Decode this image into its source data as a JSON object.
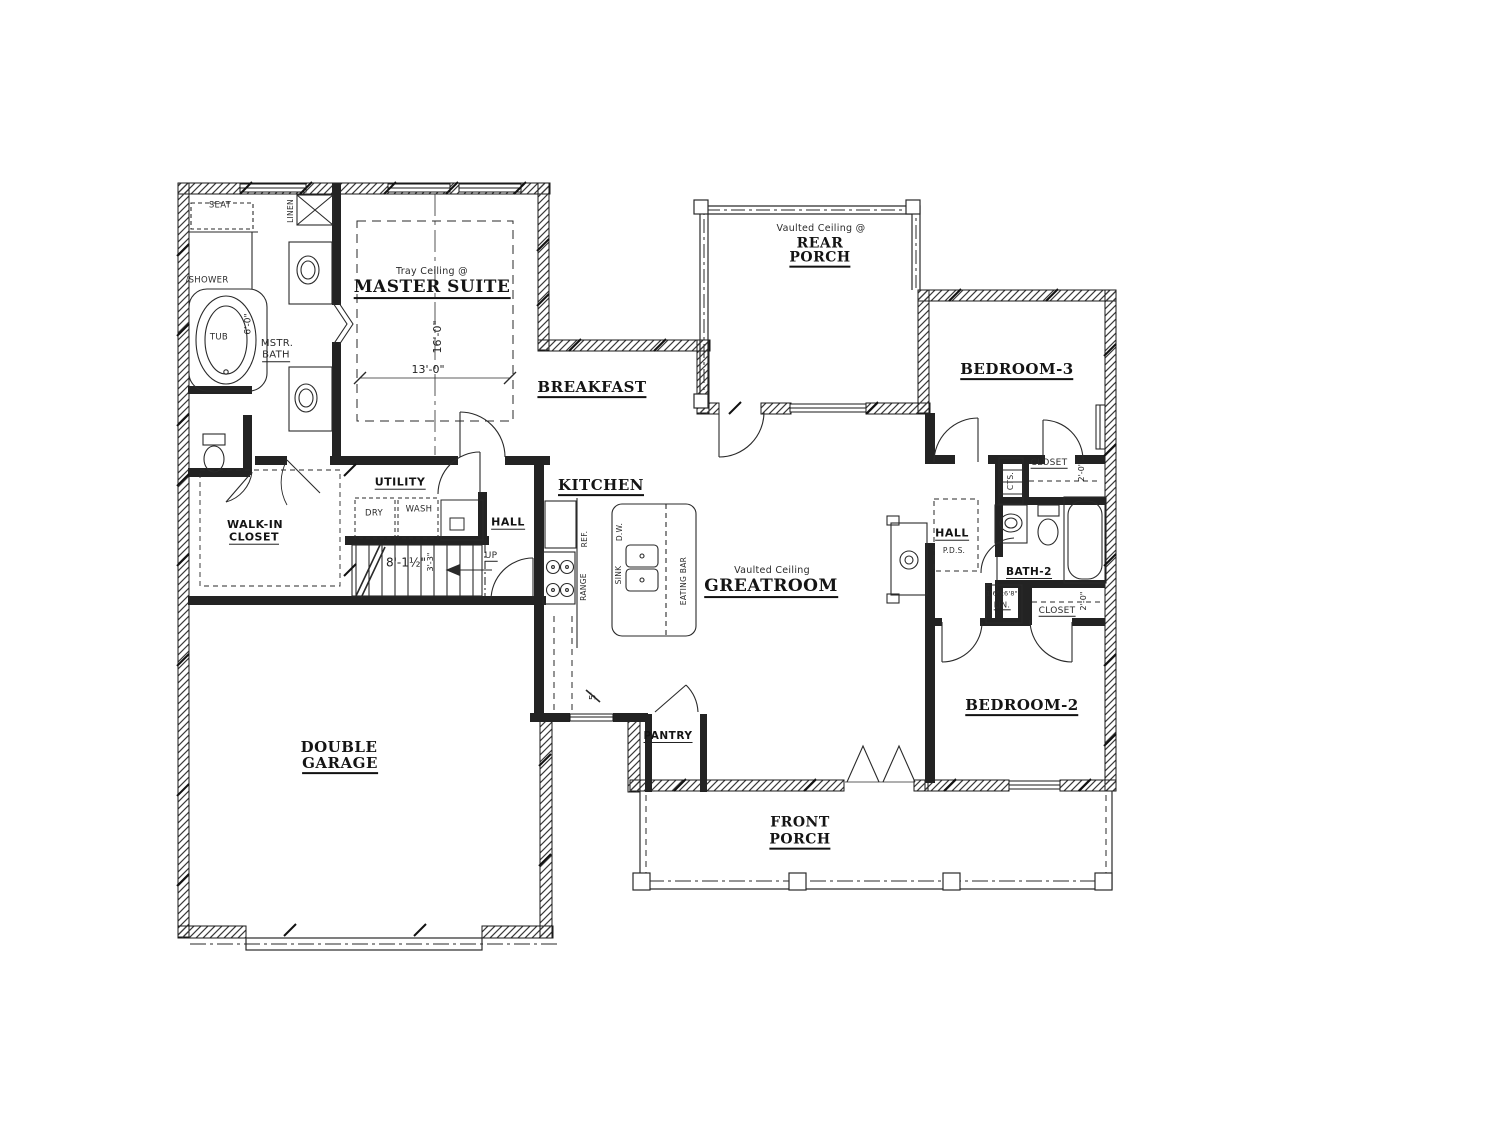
{
  "rooms": {
    "master_suite": {
      "label": "MASTER SUITE",
      "ceiling": "Tray Ceiling @",
      "depth": "16'-0\"",
      "width": "13'-0\""
    },
    "master_bath": {
      "label_line1": "MSTR.",
      "label_line2": "BATH"
    },
    "walk_in_closet": {
      "label_line1": "WALK-IN",
      "label_line2": "CLOSET"
    },
    "breakfast": {
      "label": "BREAKFAST"
    },
    "kitchen": {
      "label": "KITCHEN",
      "counter_dim": "5'"
    },
    "utility": {
      "label": "UTILITY"
    },
    "hall_main": {
      "label": "HALL"
    },
    "hall_bedroom": {
      "label": "HALL",
      "note": "P.D.S."
    },
    "stairs": {
      "dim_run": "8'-1½\"",
      "dim_width": "3'-3\"",
      "direction": "UP"
    },
    "rear_porch": {
      "label_line1": "REAR",
      "label_line2": "PORCH",
      "ceiling": "Vaulted Ceiling @"
    },
    "greatroom": {
      "label": "GREATROOM",
      "ceiling": "Vaulted Ceiling"
    },
    "bedroom_3": {
      "label": "BEDROOM-3"
    },
    "bedroom_2": {
      "label": "BEDROOM-2"
    },
    "bath_2": {
      "label": "BATH-2"
    },
    "double_garage": {
      "label_line1": "DOUBLE",
      "label_line2": "GARAGE"
    },
    "pantry": {
      "label": "PANTRY"
    },
    "front_porch": {
      "label_line1": "FRONT",
      "label_line2": "PORCH"
    }
  },
  "fixtures": {
    "seat": "SEAT",
    "shower": "/SHOWER",
    "tub": "TUB",
    "tub_dim": "6'-0\"",
    "linen": "LINEN",
    "dryer": "DRY",
    "washer": "WASH",
    "refrigerator": "REF.",
    "range": "RANGE",
    "dishwasher": "D.W.",
    "sink": "SINK",
    "eating_bar": "EATING BAR",
    "coats": "CTS.",
    "closet_bedroom3": "CLOSET",
    "closet_bedroom3_dim": "2'-0\"",
    "linen_closet": "LIN.",
    "linen_closet_door": "1'6\"x6'8\"",
    "closet_bedroom2": "CLOSET",
    "closet_bedroom2_dim": "2'-0\""
  },
  "colors": {
    "line": "#1f1f1f",
    "text": "#141414",
    "background": "#ffffff"
  }
}
